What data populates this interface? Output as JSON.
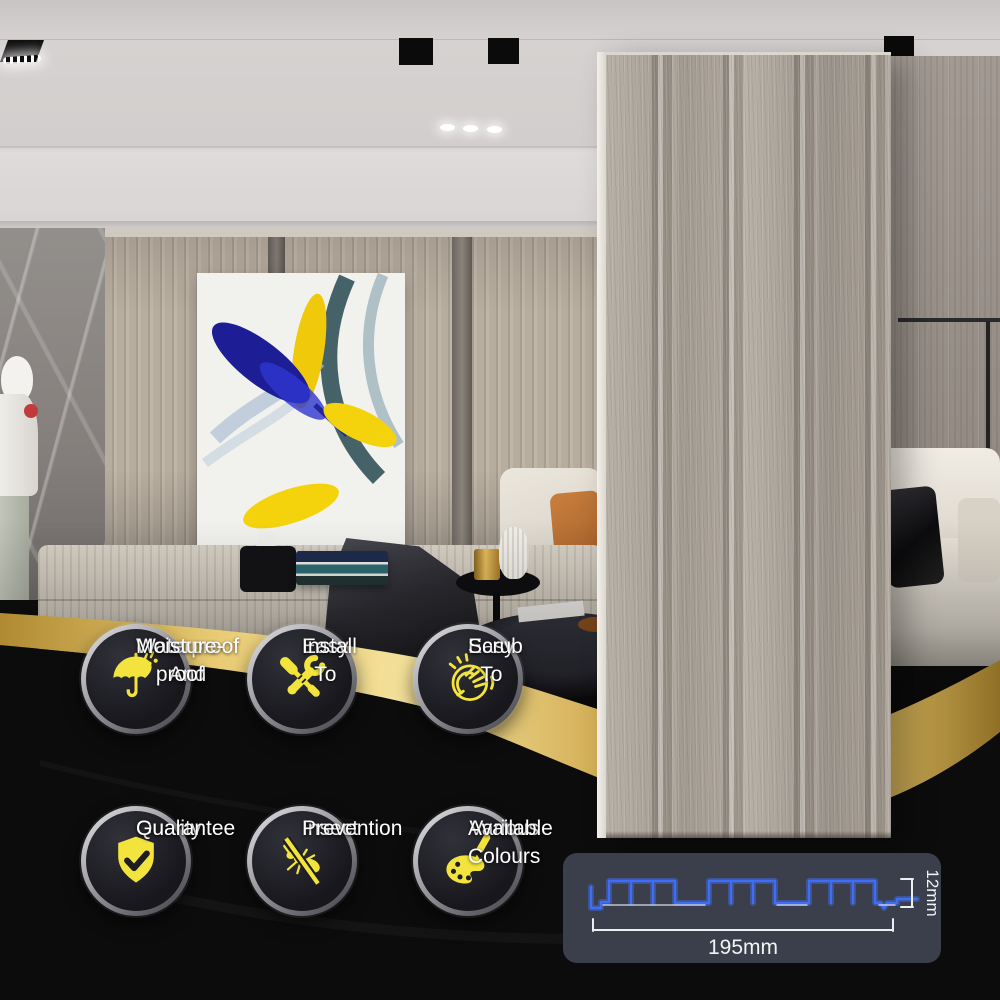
{
  "badges": [
    {
      "icon": "umbrella-rain-icon",
      "line1": "Waterproof And",
      "line2": "Moisture-proof"
    },
    {
      "icon": "tools-icon",
      "line1": "Easy To",
      "line2": "Install"
    },
    {
      "icon": "scrub-hand-icon",
      "line1": "Easy To",
      "line2": "Scrub"
    },
    {
      "icon": "shield-check-icon",
      "line1": "Quality",
      "line2": "Guarantee"
    },
    {
      "icon": "no-insect-icon",
      "line1": "Insect",
      "line2": "Prevention"
    },
    {
      "icon": "palette-brush-icon",
      "line1": "Various Colours",
      "line2": "Available"
    }
  ],
  "spec_diagram": {
    "width_label": "195mm",
    "height_label": "12mm"
  },
  "colors": {
    "accent_yellow": "#f2e43c",
    "ribbon_gold": "#e2c169",
    "background_black": "#0c0c0c",
    "spec_card_bg": "#3a3f4b",
    "profile_blue": "#3e6ef5",
    "panel_wood": "#aca49a"
  }
}
